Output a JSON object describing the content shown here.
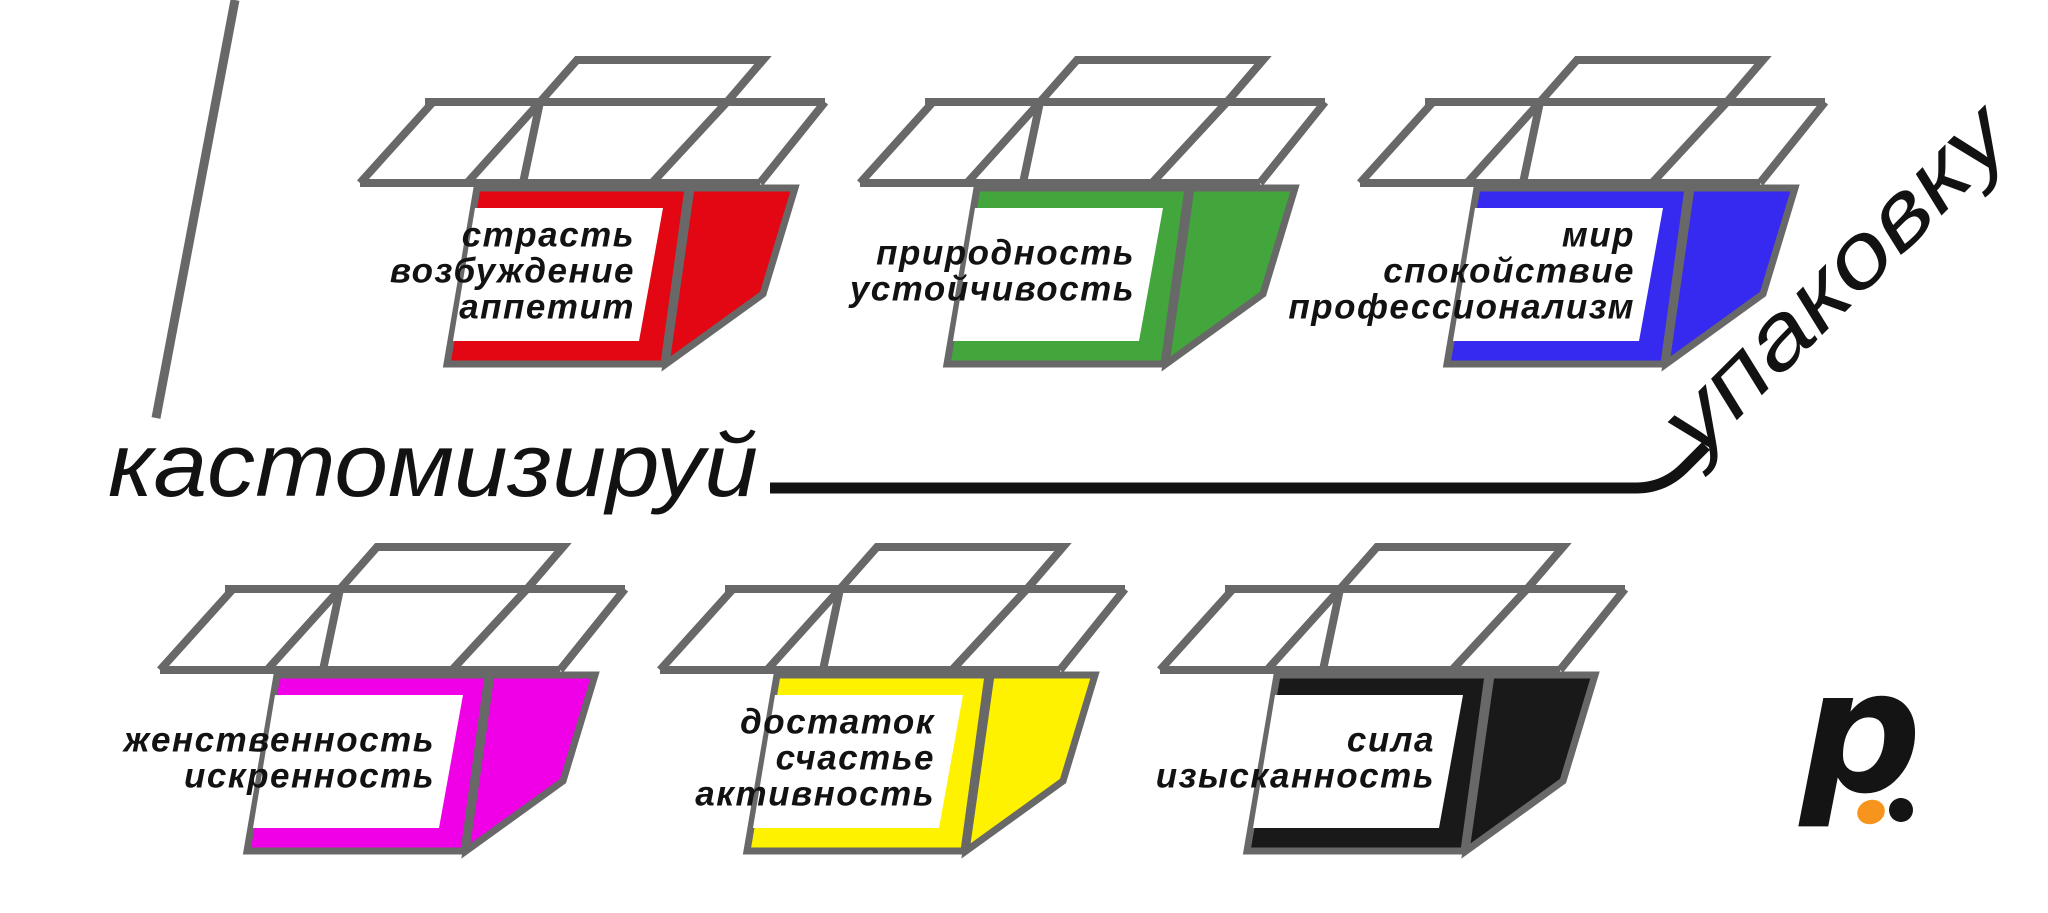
{
  "palette": {
    "outline": "#686868",
    "ink": "#121212",
    "logo_orange": "#F7941D",
    "logo_black": "#141414"
  },
  "headline": {
    "left": "кастомизируй",
    "right": "упаковку"
  },
  "boxes": [
    {
      "id": "red",
      "color": "#E30613",
      "labels": [
        "страсть",
        "возбуждение",
        "аппетит"
      ]
    },
    {
      "id": "green",
      "color": "#42A63C",
      "labels": [
        "природность",
        "устойчивость"
      ]
    },
    {
      "id": "blue",
      "color": "#3629F0",
      "labels": [
        "мир",
        "спокойствие",
        "профессионализм"
      ]
    },
    {
      "id": "magenta",
      "color": "#F000E6",
      "labels": [
        "женственность",
        "искренность"
      ]
    },
    {
      "id": "yellow",
      "color": "#FFF200",
      "labels": [
        "достаток",
        "счастье",
        "активность"
      ]
    },
    {
      "id": "black",
      "color": "#191919",
      "labels": [
        "сила",
        "изысканность"
      ]
    }
  ],
  "logo": {
    "letter": "p"
  }
}
